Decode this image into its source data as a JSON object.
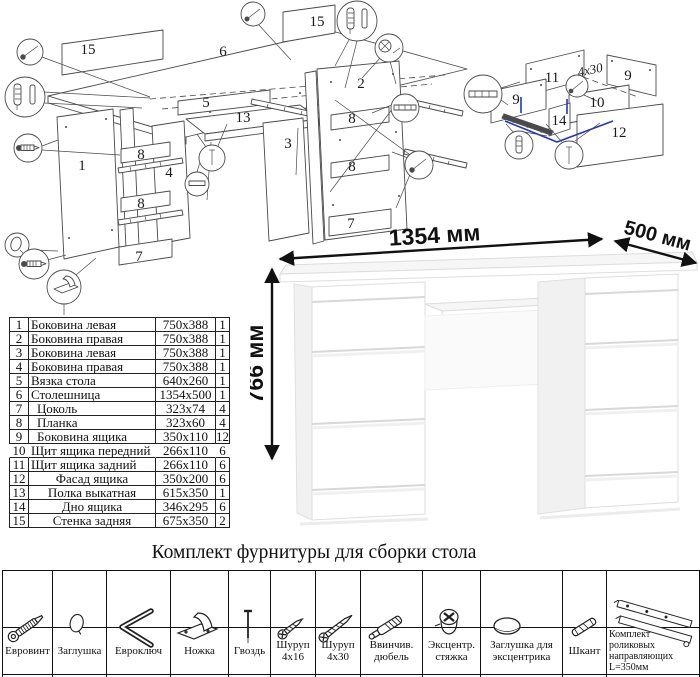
{
  "hardware": {
    "title": "Комплект фурнитуры для сборки стола",
    "items": [
      {
        "name": "Евровинт",
        "qty": "36",
        "icon": "confirmat-screw"
      },
      {
        "name": "Заглушка",
        "qty": "8",
        "icon": "cap"
      },
      {
        "name": "Евроключ",
        "qty": "1",
        "icon": "hex-key"
      },
      {
        "name": "Ножка",
        "qty": "8",
        "icon": "foot"
      },
      {
        "name": "Гвоздь",
        "qty": "50",
        "icon": "nail"
      },
      {
        "name": "Шуруп 4x16",
        "qty": "56",
        "icon": "screw-small"
      },
      {
        "name": "Шуруп 4x30",
        "qty": "12",
        "icon": "screw-long"
      },
      {
        "name": "Ввинчив. дюбель",
        "qty": "8",
        "icon": "threaded-dowel"
      },
      {
        "name": "Эксцентр. стяжка",
        "qty": "8",
        "icon": "cam-lock"
      },
      {
        "name": "Заглушка для эксцентрика",
        "qty": "8",
        "icon": "cam-cap"
      },
      {
        "name": "Шкант",
        "qty": "24",
        "icon": "wood-dowel"
      },
      {
        "name": "Комплект роликовых направляющих L=350мм",
        "qty": "7",
        "icon": "drawer-slide"
      }
    ]
  },
  "parts_table": {
    "rows": [
      {
        "num": "1",
        "name": "Боковина левая",
        "size": "750x388",
        "qty": "1"
      },
      {
        "num": "2",
        "name": "Боковина правая",
        "size": "750x388",
        "qty": "1"
      },
      {
        "num": "3",
        "name": "Боковина левая",
        "size": "750x388",
        "qty": "1"
      },
      {
        "num": "4",
        "name": "Боковина правая",
        "size": "750x388",
        "qty": "1"
      },
      {
        "num": "5",
        "name": "Вязка стола",
        "size": "640x260",
        "qty": "1"
      },
      {
        "num": "6",
        "name": "Столешница",
        "size": "1354x500",
        "qty": "1"
      },
      {
        "num": "7",
        "name": "Цоколь",
        "size": "323x74",
        "qty": "4"
      },
      {
        "num": "8",
        "name": "Планка",
        "size": "323x60",
        "qty": "4"
      },
      {
        "num": "9",
        "name": "Боковина ящика",
        "size": "350x110",
        "qty": "12"
      },
      {
        "num": "10",
        "name": "Щит ящика передний",
        "size": "266x110",
        "qty": "6"
      },
      {
        "num": "11",
        "name": "Щит ящика задний",
        "size": "266x110",
        "qty": "6"
      },
      {
        "num": "12",
        "name": "Фасад ящика",
        "size": "350x200",
        "qty": "6"
      },
      {
        "num": "13",
        "name": "Полка выкатная",
        "size": "615x350",
        "qty": "1"
      },
      {
        "num": "14",
        "name": "Дно ящика",
        "size": "346x295",
        "qty": "6"
      },
      {
        "num": "15",
        "name": "Стенка задняя",
        "size": "675x350",
        "qty": "2"
      }
    ]
  },
  "desk_view": {
    "width_label": "1354 мм",
    "depth_label": "500 мм",
    "height_label": "766 мм"
  },
  "assembly_diagram": {
    "labels": [
      "15",
      "6",
      "15",
      "1",
      "8",
      "4",
      "8",
      "7",
      "5",
      "13",
      "3",
      "2",
      "8",
      "8",
      "7"
    ],
    "callout_icons": [
      "confirmat-screw",
      "dowel-pin-pair",
      "confirmat-screw",
      "cap",
      "confirmat-screw",
      "foot-nail",
      "confirmat-screw",
      "dowel-pin-pair",
      "cam-lock-screw",
      "drawer-slide",
      "confirmat-screw",
      "screw-vertical",
      "slide-profile"
    ]
  },
  "drawer_diagram": {
    "labels": [
      "11",
      "9",
      "9",
      "10",
      "14",
      "12"
    ],
    "screw_note": "4x30",
    "callout_icons": [
      "drawer-slide",
      "threaded-dowel",
      "nail",
      "screw-4x30"
    ]
  },
  "colors": {
    "accent_blue": "#2233cc",
    "diagram_line": "#4a4a4a",
    "table_border": "#111111"
  }
}
